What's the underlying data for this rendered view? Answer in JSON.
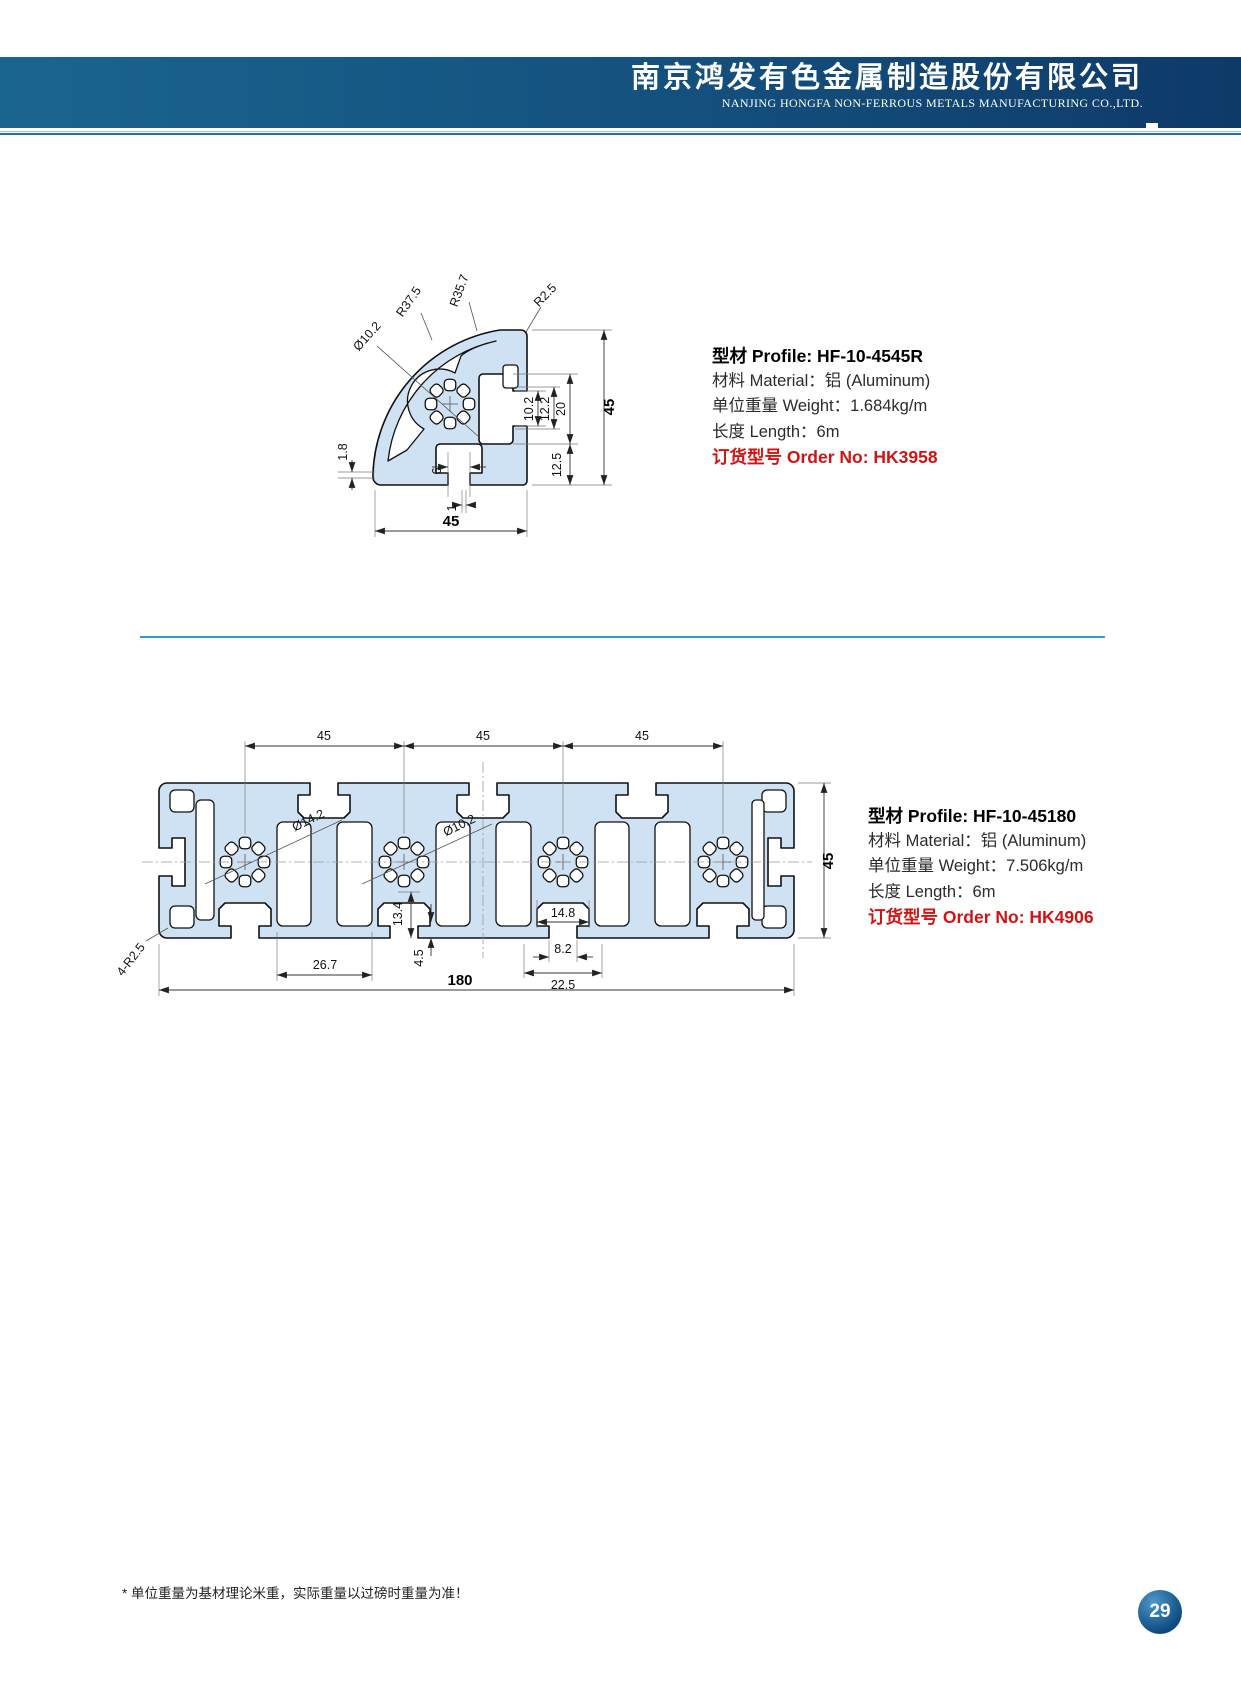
{
  "header": {
    "company_zh": "南京鸿发有色金属制造股份有限公司",
    "company_en": "NANJING HONGFA NON-FERROUS METALS MANUFACTURING CO.,LTD."
  },
  "profiles": [
    {
      "title": "型材 Profile:  HF-10-4545R",
      "material": "材料 Material：铝 (Aluminum)",
      "weight": "单位重量 Weight：1.684kg/m",
      "length": "长度 Length：6m",
      "order": "订货型号 Order No:  HK3958",
      "dims": {
        "r1": "R37.5",
        "r2": "R35.7",
        "r3": "R2.5",
        "bore": "Ø10.2",
        "t18": "1.8",
        "t6": "6",
        "t1": "1",
        "s102": "10.2",
        "s122": "12.2",
        "s20": "20",
        "s125": "12.5",
        "width": "45",
        "height": "45"
      }
    },
    {
      "title": "型材 Profile:  HF-10-45180",
      "material": "材料 Material：铝 (Aluminum)",
      "weight": "单位重量 Weight：7.506kg/m",
      "length": "长度 Length：6m",
      "order": "订货型号 Order No:  HK4906",
      "dims": {
        "p45a": "45",
        "p45b": "45",
        "p45c": "45",
        "bore1": "Ø14.2",
        "bore2": "Ø10.2",
        "c148": "14.8",
        "c134": "13.4",
        "c45": "4.5",
        "c267": "26.7",
        "c82": "8.2",
        "c225": "22.5",
        "total": "180",
        "corner": "4-R2.5",
        "height": "45"
      }
    }
  ],
  "footer": {
    "note": "* 单位重量为基材理论米重，实际重量以过磅时重量为准！",
    "page": "29"
  },
  "colors": {
    "profile_fill": "#cfe2f4",
    "order_red": "#d01414",
    "divider_blue": "#2b9cd8",
    "header_dark": "#0e3a68",
    "header_light": "#1a6590"
  }
}
